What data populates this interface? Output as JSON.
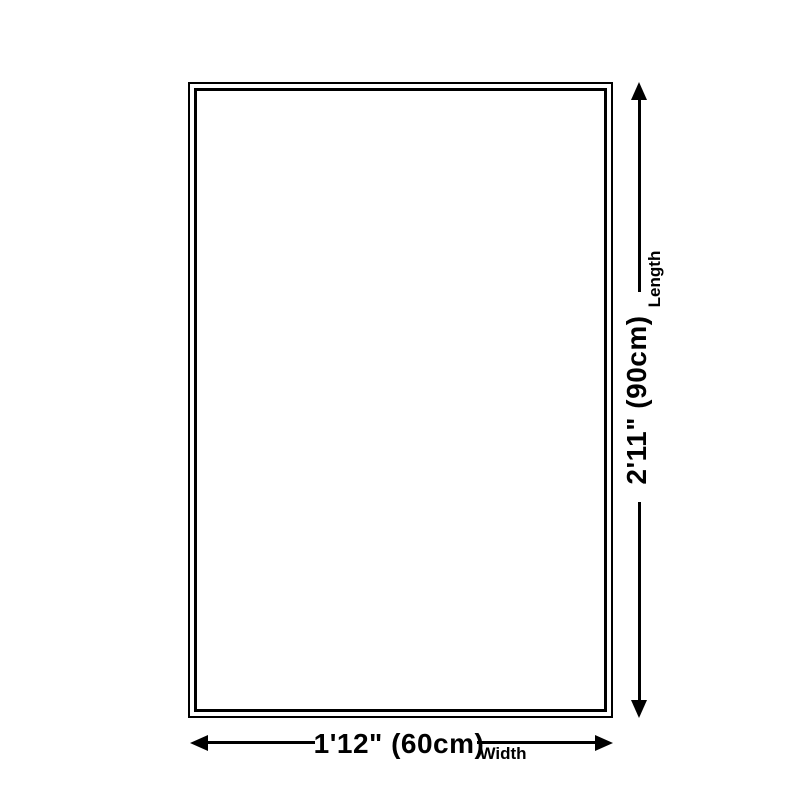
{
  "diagram": {
    "background_color": "#ffffff",
    "line_color": "#000000",
    "rug": {
      "shape": "rectangle",
      "border_style": "double"
    },
    "length_dimension": {
      "value": "2'11\" (90cm)",
      "label": "Length",
      "orientation": "vertical"
    },
    "width_dimension": {
      "value": "1'12\" (60cm)",
      "label": "Width",
      "orientation": "horizontal"
    }
  }
}
